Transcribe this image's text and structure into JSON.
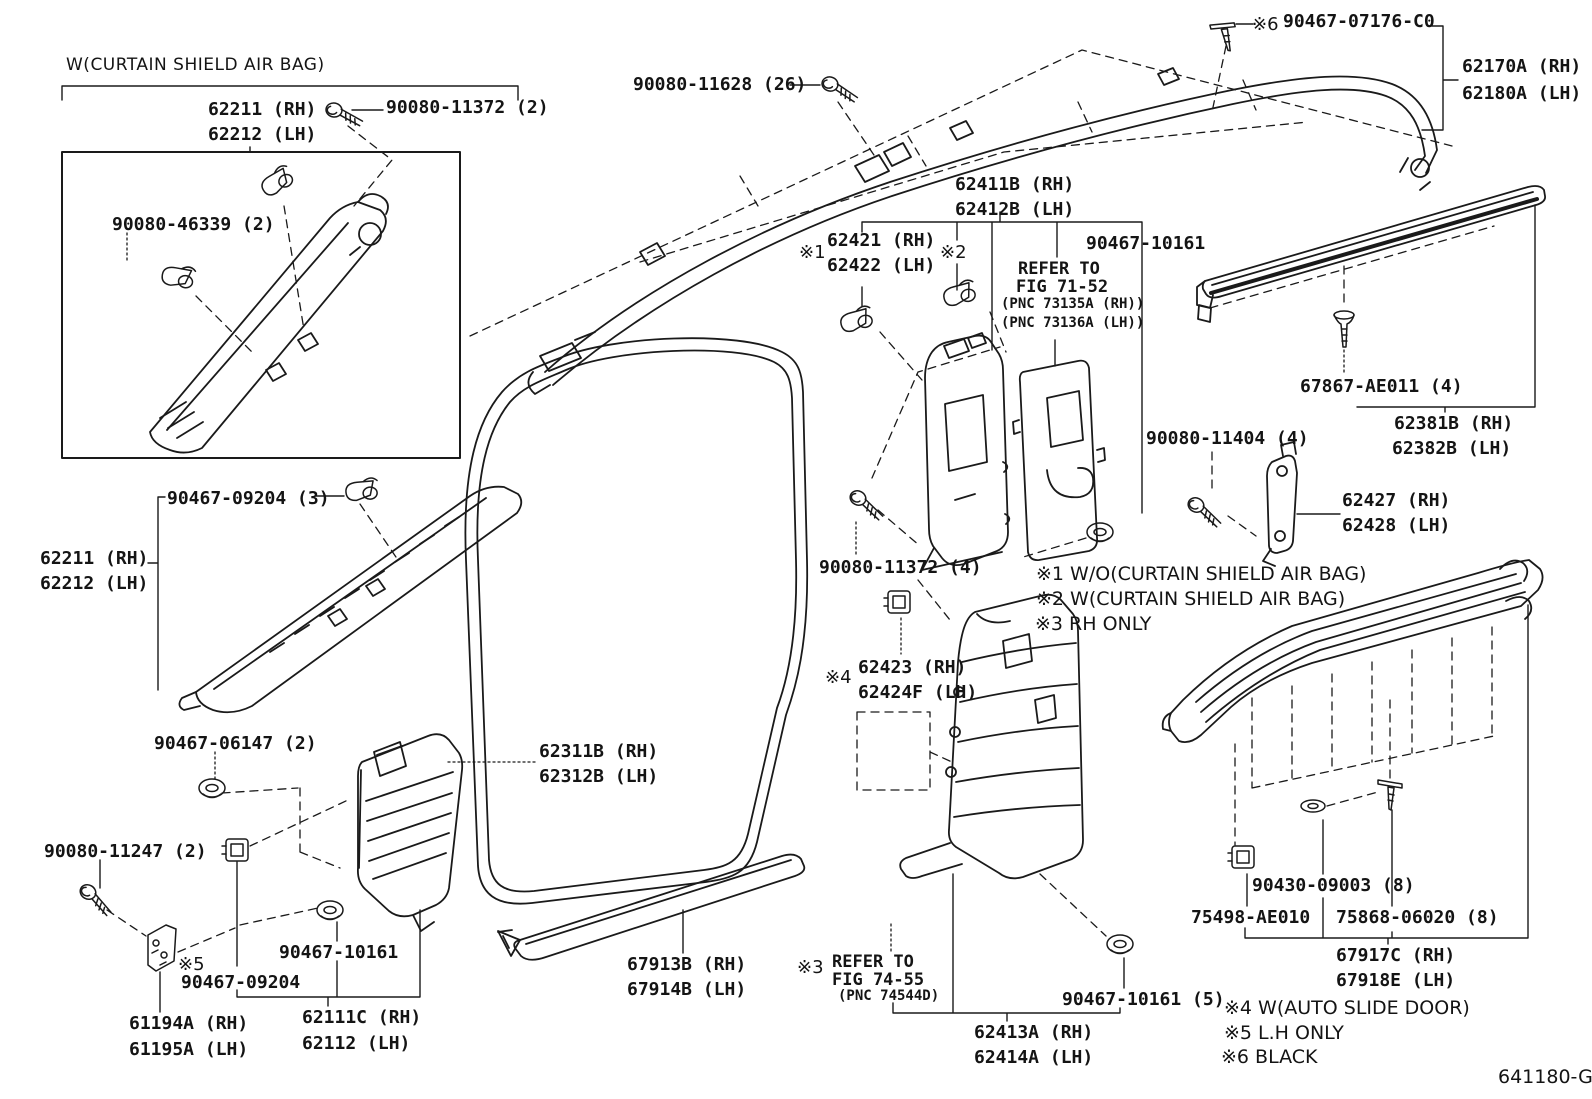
{
  "page": {
    "background": "#ffffff",
    "line_color": "#1a1a1a",
    "drawing_code": "641180-G"
  },
  "legend": [
    {
      "mark": "※1",
      "meaning": "W/O(CURTAIN SHIELD AIR BAG)"
    },
    {
      "mark": "※2",
      "meaning": "W(CURTAIN SHIELD AIR BAG)"
    },
    {
      "mark": "※3",
      "meaning": "RH ONLY"
    },
    {
      "mark": "※4",
      "meaning": "W(AUTO SLIDE DOOR)"
    },
    {
      "mark": "※5",
      "meaning": "L.H ONLY"
    },
    {
      "mark": "※6",
      "meaning": "BLACK"
    }
  ],
  "labels": [
    {
      "t": "W(CURTAIN SHIELD AIR BAG)",
      "x": 66,
      "y": 55,
      "s": "header",
      "n": "section-note-curtain-airbag",
      "i": false
    },
    {
      "t": "62211 (RH)",
      "x": 208,
      "y": 100,
      "s": "part",
      "n": "label-62211-rh-top",
      "i": true
    },
    {
      "t": "62212 (LH)",
      "x": 208,
      "y": 125,
      "s": "part",
      "n": "label-62212-lh-top",
      "i": true
    },
    {
      "t": "90080-11372 (2)",
      "x": 386,
      "y": 98,
      "s": "part",
      "n": "label-90080-11372-2",
      "i": true
    },
    {
      "t": "90080-46339 (2)",
      "x": 112,
      "y": 215,
      "s": "part",
      "n": "label-90080-46339-2",
      "i": true
    },
    {
      "t": "90080-11628 (26)",
      "x": 633,
      "y": 75,
      "s": "part",
      "n": "label-90080-11628-26",
      "i": true
    },
    {
      "t": "※6",
      "x": 1252,
      "y": 15,
      "s": "mark",
      "n": "mark-6-90467",
      "i": false
    },
    {
      "t": "90467-07176-C0",
      "x": 1283,
      "y": 12,
      "s": "part",
      "n": "label-90467-07176-c0",
      "i": true
    },
    {
      "t": "62170A (RH)",
      "x": 1462,
      "y": 57,
      "s": "part",
      "n": "label-62170a-rh",
      "i": true
    },
    {
      "t": "62180A (LH)",
      "x": 1462,
      "y": 84,
      "s": "part",
      "n": "label-62180a-lh",
      "i": true
    },
    {
      "t": "62411B (RH)",
      "x": 955,
      "y": 175,
      "s": "part",
      "n": "label-62411b-rh",
      "i": true
    },
    {
      "t": "62412B (LH)",
      "x": 955,
      "y": 200,
      "s": "part",
      "n": "label-62412b-lh",
      "i": true
    },
    {
      "t": "※1",
      "x": 799,
      "y": 243,
      "s": "mark",
      "n": "mark-1-62421",
      "i": false
    },
    {
      "t": "62421 (RH)",
      "x": 827,
      "y": 231,
      "s": "part",
      "n": "label-62421-rh",
      "i": true
    },
    {
      "t": "62422 (LH)",
      "x": 827,
      "y": 256,
      "s": "part",
      "n": "label-62422-lh",
      "i": true
    },
    {
      "t": "※2",
      "x": 940,
      "y": 243,
      "s": "mark",
      "n": "mark-2-62421",
      "i": false
    },
    {
      "t": "90467-10161",
      "x": 1086,
      "y": 234,
      "s": "part",
      "n": "label-90467-10161-top",
      "i": true
    },
    {
      "t": "REFER TO",
      "x": 1018,
      "y": 260,
      "s": "ref",
      "n": "refer-to-fig-71-52-line1",
      "i": false
    },
    {
      "t": "FIG 71-52",
      "x": 1016,
      "y": 278,
      "s": "ref",
      "n": "refer-to-fig-71-52-line2",
      "i": false
    },
    {
      "t": "(PNC 73135A (RH))",
      "x": 1001,
      "y": 297,
      "s": "pnc",
      "n": "pnc-73135a-rh",
      "i": false
    },
    {
      "t": "(PNC 73136A (LH))",
      "x": 1001,
      "y": 316,
      "s": "pnc",
      "n": "pnc-73136a-lh",
      "i": false
    },
    {
      "t": "67867-AE011 (4)",
      "x": 1300,
      "y": 377,
      "s": "part",
      "n": "label-67867-ae011-4",
      "i": true
    },
    {
      "t": "62381B (RH)",
      "x": 1394,
      "y": 414,
      "s": "part",
      "n": "label-62381b-rh",
      "i": true
    },
    {
      "t": "62382B (LH)",
      "x": 1392,
      "y": 439,
      "s": "part",
      "n": "label-62382b-lh",
      "i": true
    },
    {
      "t": "90080-11404 (4)",
      "x": 1146,
      "y": 429,
      "s": "part",
      "n": "label-90080-11404-4",
      "i": true
    },
    {
      "t": "62427 (RH)",
      "x": 1342,
      "y": 491,
      "s": "part",
      "n": "label-62427-rh",
      "i": true
    },
    {
      "t": "62428 (LH)",
      "x": 1342,
      "y": 516,
      "s": "part",
      "n": "label-62428-lh",
      "i": true
    },
    {
      "t": "90080-11372 (4)",
      "x": 819,
      "y": 558,
      "s": "part",
      "n": "label-90080-11372-4",
      "i": true
    },
    {
      "t": "※1 W/O(CURTAIN SHIELD AIR BAG)",
      "x": 1036,
      "y": 564,
      "s": "note",
      "n": "legend-note-1",
      "i": false
    },
    {
      "t": "※2 W(CURTAIN SHIELD AIR BAG)",
      "x": 1036,
      "y": 589,
      "s": "note",
      "n": "legend-note-2",
      "i": false
    },
    {
      "t": "※3 RH ONLY",
      "x": 1035,
      "y": 614,
      "s": "note",
      "n": "legend-note-3",
      "i": false
    },
    {
      "t": "※4",
      "x": 825,
      "y": 668,
      "s": "mark",
      "n": "mark-4-62423",
      "i": false
    },
    {
      "t": "62423 (RH)",
      "x": 858,
      "y": 658,
      "s": "part",
      "n": "label-62423-rh",
      "i": true
    },
    {
      "t": "62424F (LH)",
      "x": 858,
      "y": 683,
      "s": "part",
      "n": "label-62424f-lh",
      "i": true
    },
    {
      "t": "62311B (RH)",
      "x": 539,
      "y": 742,
      "s": "part",
      "n": "label-62311b-rh",
      "i": true
    },
    {
      "t": "62312B (LH)",
      "x": 539,
      "y": 767,
      "s": "part",
      "n": "label-62312b-lh",
      "i": true
    },
    {
      "t": "90467-06147 (2)",
      "x": 154,
      "y": 734,
      "s": "part",
      "n": "label-90467-06147-2",
      "i": true
    },
    {
      "t": "90080-11247 (2)",
      "x": 44,
      "y": 842,
      "s": "part",
      "n": "label-90080-11247-2",
      "i": true
    },
    {
      "t": "90467-09204 (3)",
      "x": 167,
      "y": 489,
      "s": "part",
      "n": "label-90467-09204-3",
      "i": true
    },
    {
      "t": "62211 (RH)",
      "x": 40,
      "y": 549,
      "s": "part",
      "n": "label-62211-rh-mid",
      "i": true
    },
    {
      "t": "62212 (LH)",
      "x": 40,
      "y": 574,
      "s": "part",
      "n": "label-62212-lh-mid",
      "i": true
    },
    {
      "t": "90467-10161",
      "x": 279,
      "y": 943,
      "s": "part",
      "n": "label-90467-10161-lower",
      "i": true
    },
    {
      "t": "※5",
      "x": 178,
      "y": 955,
      "s": "mark",
      "n": "mark-5-90467",
      "i": false
    },
    {
      "t": "90467-09204",
      "x": 181,
      "y": 973,
      "s": "part",
      "n": "label-90467-09204",
      "i": true
    },
    {
      "t": "61194A (RH)",
      "x": 129,
      "y": 1014,
      "s": "part",
      "n": "label-61194a-rh",
      "i": true
    },
    {
      "t": "61195A (LH)",
      "x": 129,
      "y": 1040,
      "s": "part",
      "n": "label-61195a-lh",
      "i": true
    },
    {
      "t": "62111C (RH)",
      "x": 302,
      "y": 1008,
      "s": "part",
      "n": "label-62111c-rh",
      "i": true
    },
    {
      "t": "62112 (LH)",
      "x": 302,
      "y": 1034,
      "s": "part",
      "n": "label-62112-lh",
      "i": true
    },
    {
      "t": "67913B (RH)",
      "x": 627,
      "y": 955,
      "s": "part",
      "n": "label-67913b-rh",
      "i": true
    },
    {
      "t": "67914B (LH)",
      "x": 627,
      "y": 980,
      "s": "part",
      "n": "label-67914b-lh",
      "i": true
    },
    {
      "t": "※3",
      "x": 797,
      "y": 958,
      "s": "mark",
      "n": "mark-3-refer",
      "i": false
    },
    {
      "t": "REFER TO",
      "x": 832,
      "y": 953,
      "s": "ref",
      "n": "refer-to-fig-74-55-line1",
      "i": false
    },
    {
      "t": "FIG 74-55",
      "x": 832,
      "y": 971,
      "s": "ref",
      "n": "refer-to-fig-74-55-line2",
      "i": false
    },
    {
      "t": "(PNC 74544D)",
      "x": 838,
      "y": 989,
      "s": "pnc",
      "n": "pnc-74544d",
      "i": false
    },
    {
      "t": "62413A (RH)",
      "x": 974,
      "y": 1023,
      "s": "part",
      "n": "label-62413a-rh",
      "i": true
    },
    {
      "t": "62414A (LH)",
      "x": 974,
      "y": 1048,
      "s": "part",
      "n": "label-62414a-lh",
      "i": true
    },
    {
      "t": "90467-10161 (5)",
      "x": 1062,
      "y": 990,
      "s": "part",
      "n": "label-90467-10161-5",
      "i": true
    },
    {
      "t": "90430-09003 (8)",
      "x": 1252,
      "y": 876,
      "s": "part",
      "n": "label-90430-09003-8",
      "i": true
    },
    {
      "t": "75498-AE010",
      "x": 1191,
      "y": 908,
      "s": "part",
      "n": "label-75498-ae010",
      "i": true
    },
    {
      "t": "75868-06020 (8)",
      "x": 1336,
      "y": 908,
      "s": "part",
      "n": "label-75868-06020-8",
      "i": true
    },
    {
      "t": "67917C (RH)",
      "x": 1336,
      "y": 946,
      "s": "part",
      "n": "label-67917c-rh",
      "i": true
    },
    {
      "t": "67918E (LH)",
      "x": 1336,
      "y": 971,
      "s": "part",
      "n": "label-67918e-lh",
      "i": true
    },
    {
      "t": "※4 W(AUTO SLIDE DOOR)",
      "x": 1224,
      "y": 998,
      "s": "note",
      "n": "legend-note-4",
      "i": false
    },
    {
      "t": "※5 L.H ONLY",
      "x": 1224,
      "y": 1023,
      "s": "note",
      "n": "legend-note-5",
      "i": false
    },
    {
      "t": "※6 BLACK",
      "x": 1221,
      "y": 1047,
      "s": "note",
      "n": "legend-note-6",
      "i": false
    },
    {
      "t": "641180-G",
      "x": 1498,
      "y": 1066,
      "s": "footer",
      "n": "drawing-code",
      "i": false
    }
  ]
}
